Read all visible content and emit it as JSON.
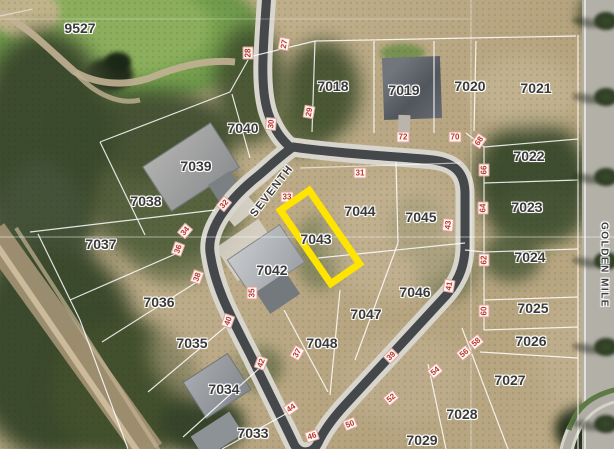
{
  "map": {
    "type": "aerial-parcel-map",
    "selected_parcel_id": "7043",
    "highlight_color": "#ffe400",
    "parcel_label_color": "#3a3a3a",
    "dimension_marker_color": "#c0342b",
    "streets": [
      {
        "name": "SEVENTH",
        "x": 272,
        "y": 191,
        "rot": -52,
        "size": 11
      },
      {
        "name": "GOLDEN MILE",
        "x": 604,
        "y": 265,
        "rot": 90,
        "size": 10
      }
    ],
    "parcel_labels": [
      {
        "id": "9527",
        "x": 80,
        "y": 28
      },
      {
        "id": "7018",
        "x": 333,
        "y": 86
      },
      {
        "id": "7019",
        "x": 404,
        "y": 90
      },
      {
        "id": "7020",
        "x": 470,
        "y": 86
      },
      {
        "id": "7021",
        "x": 536,
        "y": 88
      },
      {
        "id": "7022",
        "x": 529,
        "y": 156
      },
      {
        "id": "7023",
        "x": 527,
        "y": 207
      },
      {
        "id": "7024",
        "x": 530,
        "y": 257
      },
      {
        "id": "7025",
        "x": 533,
        "y": 308
      },
      {
        "id": "7026",
        "x": 531,
        "y": 341
      },
      {
        "id": "7027",
        "x": 510,
        "y": 380
      },
      {
        "id": "7028",
        "x": 462,
        "y": 414
      },
      {
        "id": "7029",
        "x": 422,
        "y": 440
      },
      {
        "id": "7033",
        "x": 253,
        "y": 433
      },
      {
        "id": "7034",
        "x": 224,
        "y": 389
      },
      {
        "id": "7035",
        "x": 192,
        "y": 343
      },
      {
        "id": "7036",
        "x": 159,
        "y": 302
      },
      {
        "id": "7037",
        "x": 101,
        "y": 244
      },
      {
        "id": "7038",
        "x": 146,
        "y": 201
      },
      {
        "id": "7039",
        "x": 196,
        "y": 166
      },
      {
        "id": "7040",
        "x": 243,
        "y": 128
      },
      {
        "id": "7042",
        "x": 272,
        "y": 270
      },
      {
        "id": "7043",
        "x": 316,
        "y": 239
      },
      {
        "id": "7044",
        "x": 360,
        "y": 211
      },
      {
        "id": "7045",
        "x": 421,
        "y": 217
      },
      {
        "id": "7046",
        "x": 415,
        "y": 292
      },
      {
        "id": "7047",
        "x": 366,
        "y": 314
      },
      {
        "id": "7048",
        "x": 322,
        "y": 343
      }
    ],
    "dimension_markers": [
      {
        "text": "28",
        "x": 248,
        "y": 53,
        "rot": -90
      },
      {
        "text": "27",
        "x": 284,
        "y": 44,
        "rot": -80
      },
      {
        "text": "29",
        "x": 309,
        "y": 112,
        "rot": -80
      },
      {
        "text": "30",
        "x": 271,
        "y": 124,
        "rot": -85
      },
      {
        "text": "32",
        "x": 224,
        "y": 204,
        "rot": -50
      },
      {
        "text": "34",
        "x": 185,
        "y": 231,
        "rot": -50
      },
      {
        "text": "36",
        "x": 178,
        "y": 249,
        "rot": -70
      },
      {
        "text": "38",
        "x": 197,
        "y": 277,
        "rot": -70
      },
      {
        "text": "40",
        "x": 228,
        "y": 321,
        "rot": -70
      },
      {
        "text": "42",
        "x": 261,
        "y": 363,
        "rot": -70
      },
      {
        "text": "44",
        "x": 291,
        "y": 408,
        "rot": -35
      },
      {
        "text": "46",
        "x": 312,
        "y": 436,
        "rot": -18
      },
      {
        "text": "50",
        "x": 350,
        "y": 424,
        "rot": -22
      },
      {
        "text": "52",
        "x": 391,
        "y": 398,
        "rot": -40
      },
      {
        "text": "54",
        "x": 435,
        "y": 371,
        "rot": -40
      },
      {
        "text": "56",
        "x": 464,
        "y": 353,
        "rot": -40
      },
      {
        "text": "58",
        "x": 476,
        "y": 342,
        "rot": -40
      },
      {
        "text": "72",
        "x": 403,
        "y": 137,
        "rot": 0
      },
      {
        "text": "70",
        "x": 455,
        "y": 137,
        "rot": 0
      },
      {
        "text": "68",
        "x": 479,
        "y": 141,
        "rot": -55
      },
      {
        "text": "66",
        "x": 484,
        "y": 170,
        "rot": -90
      },
      {
        "text": "64",
        "x": 483,
        "y": 208,
        "rot": -90
      },
      {
        "text": "62",
        "x": 484,
        "y": 260,
        "rot": -90
      },
      {
        "text": "60",
        "x": 484,
        "y": 311,
        "rot": -90
      },
      {
        "text": "31",
        "x": 360,
        "y": 173,
        "rot": 0
      },
      {
        "text": "33",
        "x": 287,
        "y": 197,
        "rot": 0
      },
      {
        "text": "35",
        "x": 252,
        "y": 293,
        "rot": -90
      },
      {
        "text": "37",
        "x": 297,
        "y": 353,
        "rot": -60
      },
      {
        "text": "39",
        "x": 391,
        "y": 356,
        "rot": -45
      },
      {
        "text": "41",
        "x": 449,
        "y": 286,
        "rot": -80
      },
      {
        "text": "43",
        "x": 448,
        "y": 225,
        "rot": -85
      }
    ],
    "highlight_box": {
      "x": 320,
      "y": 237,
      "w": 42,
      "h": 96,
      "rot": -34.5,
      "stroke_px": 7
    }
  }
}
